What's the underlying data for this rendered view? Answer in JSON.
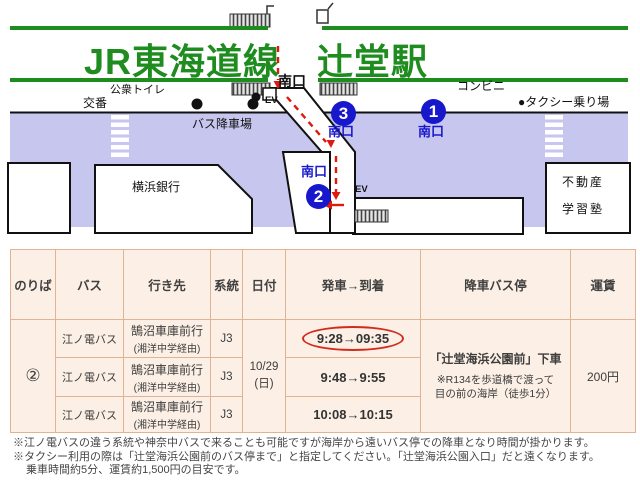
{
  "map": {
    "title": "JR東海道線　辻堂駅",
    "labels": {
      "public_toilet": "公衆トイレ",
      "koban": "交番",
      "ev_top": "EV",
      "bus_dropoff": "バス降車場",
      "conbini": "コンビニ",
      "taxi": "●タクシー乗り場",
      "bank": "横浜銀行",
      "fudosan": "不動産",
      "juku": "学習塾",
      "ev_bottom": "EV",
      "exit_station": "南口",
      "exit_1": "南口",
      "exit_2": "南口",
      "exit_3": "南口"
    },
    "stops": {
      "one": "1",
      "two": "2",
      "three": "3"
    },
    "colors": {
      "green": "#1f8c1f",
      "road": "#c6c6ef",
      "blue": "#1717cc",
      "red": "#dd1a0f"
    }
  },
  "table": {
    "headers": [
      "のりば",
      "バス",
      "行き先",
      "系統",
      "日付",
      "発車→到着",
      "降車バス停",
      "運賃"
    ],
    "platform": "②",
    "date_line1": "10/29",
    "date_line2": "(日)",
    "rows": [
      {
        "bus": "江ノ電バス",
        "dest": "鵠沼車庫前行",
        "via": "(湘洋中学経由)",
        "route": "J3",
        "time": "9:28→09:35"
      },
      {
        "bus": "江ノ電バス",
        "dest": "鵠沼車庫前行",
        "via": "(湘洋中学経由)",
        "route": "J3",
        "time": "9:48→9:55"
      },
      {
        "bus": "江ノ電バス",
        "dest": "鵠沼車庫前行",
        "via": "(湘洋中学経由)",
        "route": "J3",
        "time": "10:08→10:15"
      }
    ],
    "dropoff_title": "「辻堂海浜公園前」下車",
    "dropoff_note1": "※R134を歩道橋で渡って",
    "dropoff_note2": "目の前の海岸（徒歩1分）",
    "fare": "200円"
  },
  "notes": [
    "※江ノ電バスの違う系統や神奈中バスで来ることも可能ですが海岸から遠いバス停での降車となり時間が掛かります。",
    "※タクシー利用の際は「辻堂海浜公園前のバス停まで」と指定してください。「辻堂海浜公園入口」だと遠くなります。",
    "乗車時間約5分、運賃約1,500円の目安です。"
  ]
}
